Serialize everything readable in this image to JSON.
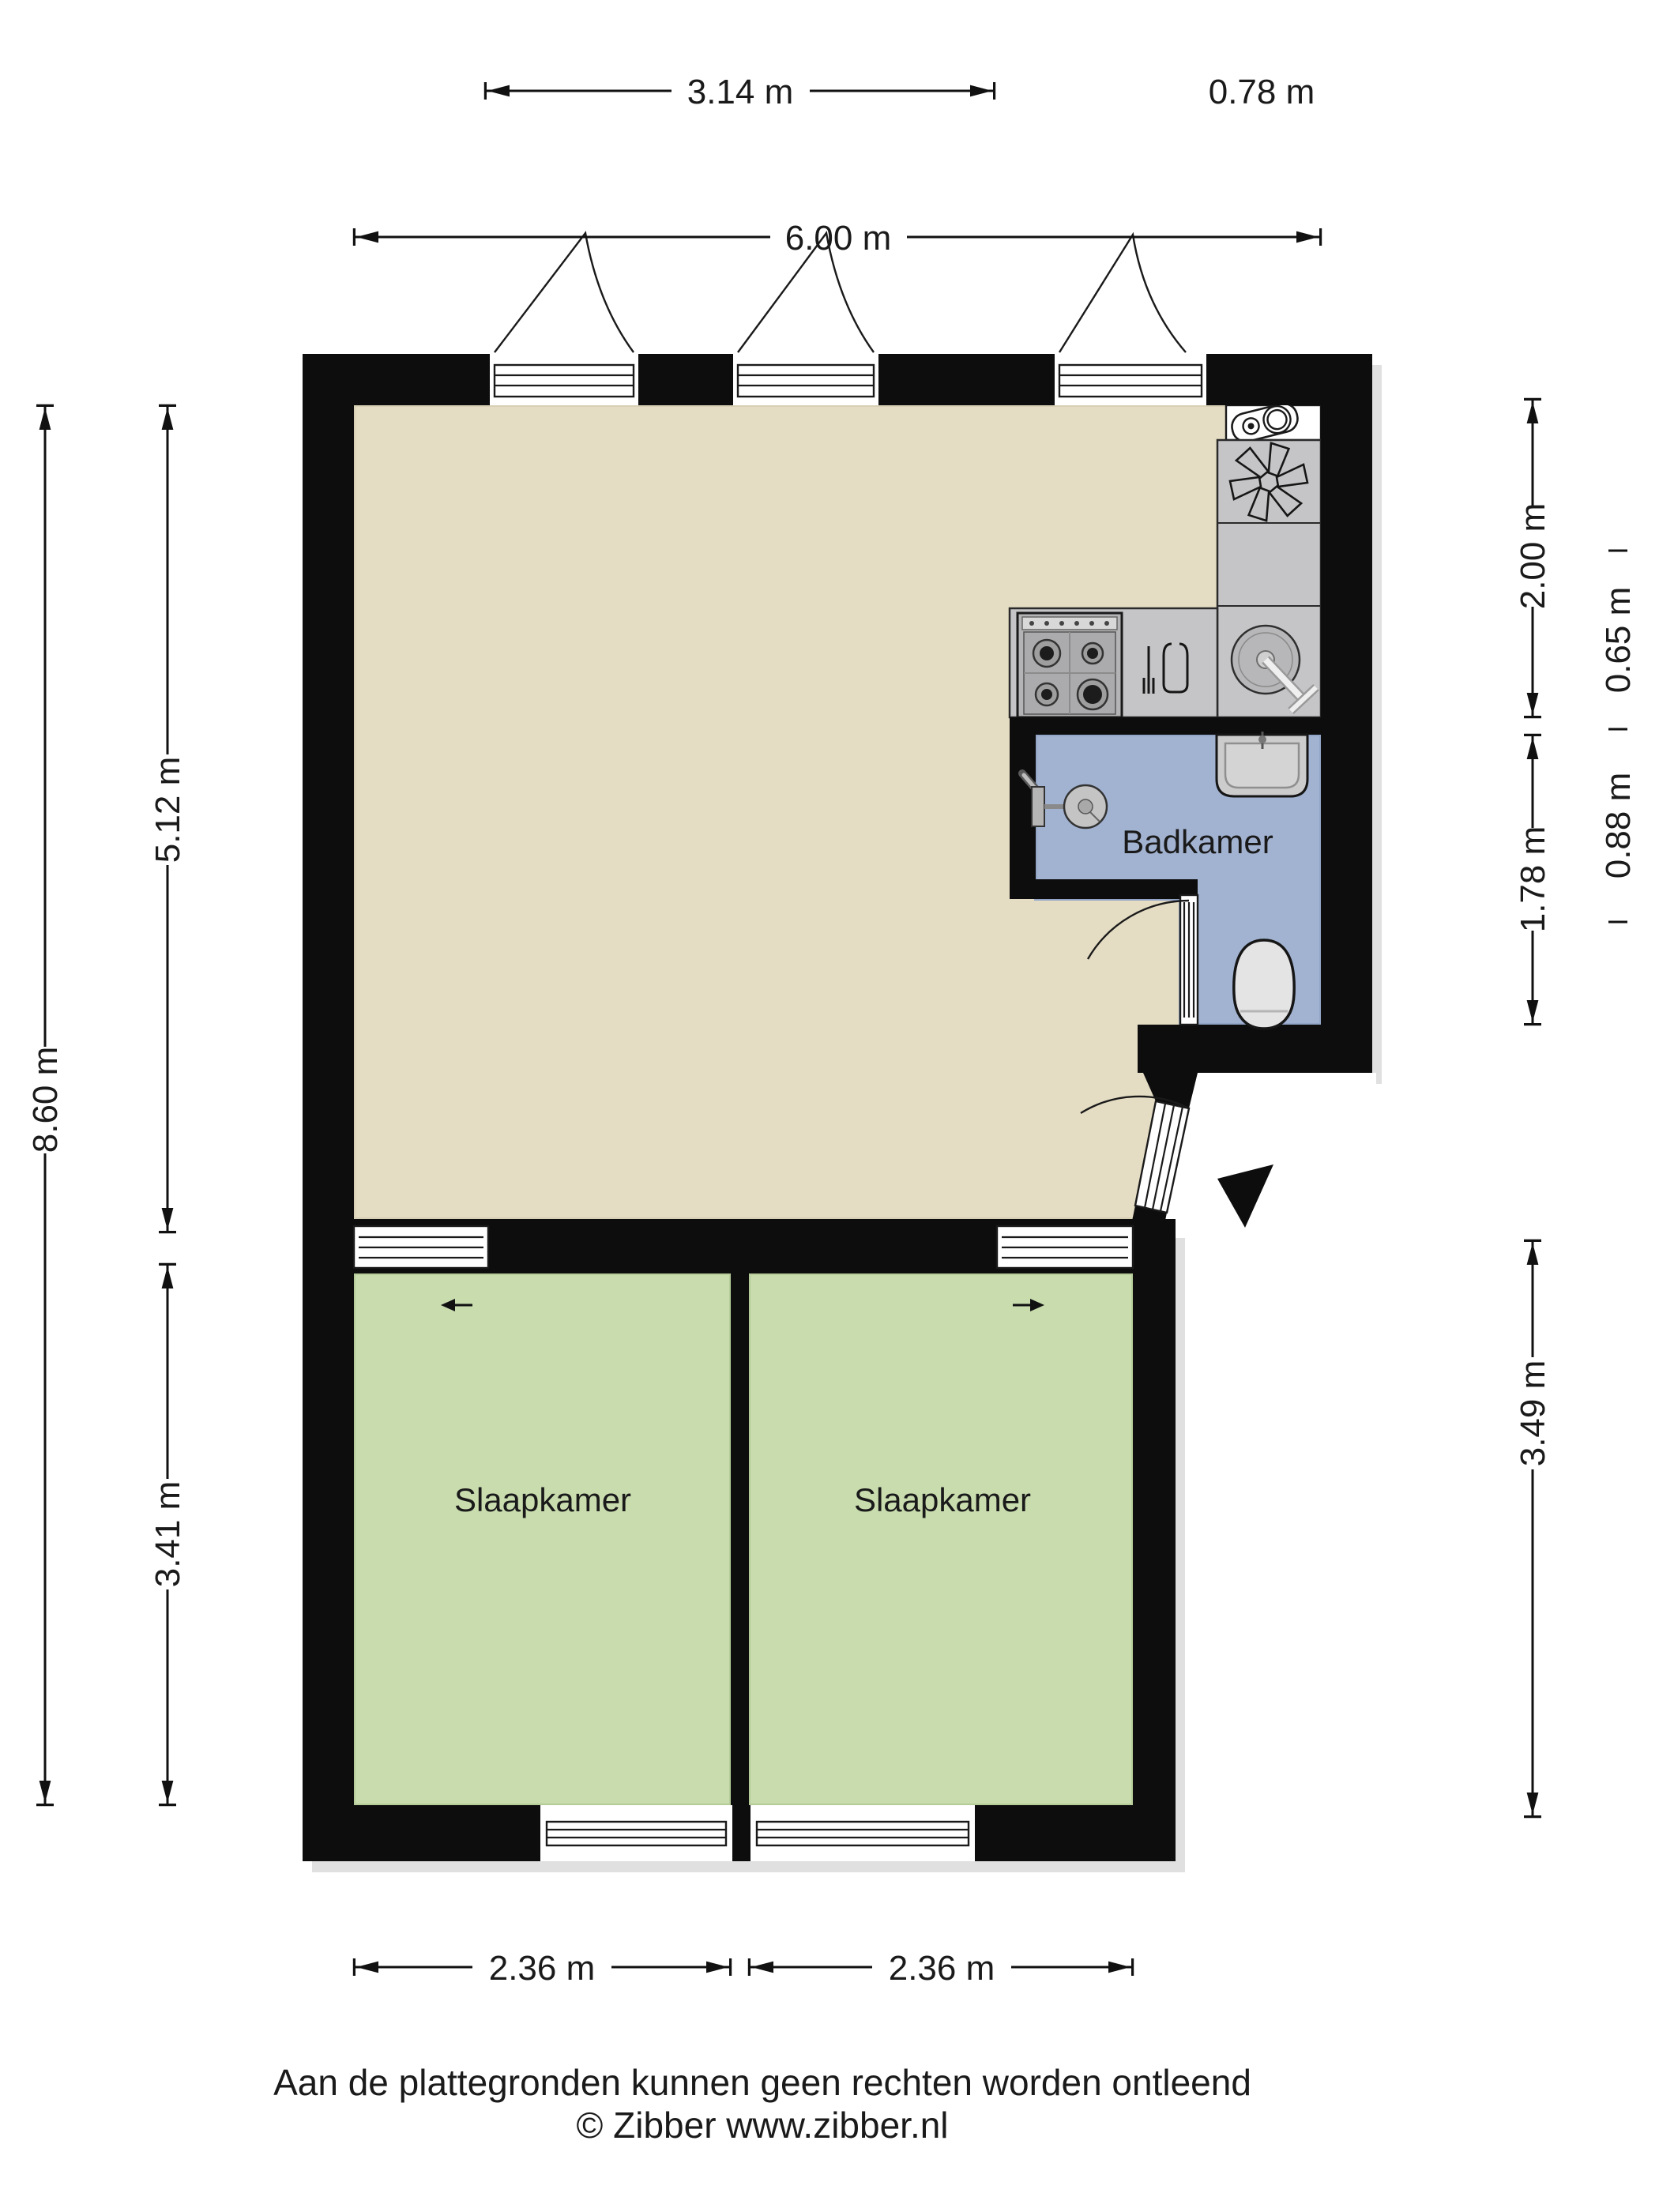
{
  "dimensions": {
    "top_inner": "3.14 m",
    "top_kitchen": "0.78 m",
    "top_total": "6.00 m",
    "left_total": "8.60 m",
    "left_living": "5.12 m",
    "left_bedroom": "3.41 m",
    "right_kitchen": "2.00 m",
    "right_kitchen_width": "0.65 m",
    "right_bathroom_width": "0.88 m",
    "right_bathroom": "1.78 m",
    "right_bedroom": "3.49 m",
    "bottom_bedroom_left": "2.36 m",
    "bottom_bedroom_right": "2.36 m"
  },
  "rooms": {
    "bathroom": "Badkamer",
    "bedroom_left": "Slaapkamer",
    "bedroom_right": "Slaapkamer"
  },
  "footer": {
    "disclaimer": "Aan de plattegronden kunnen geen rechten worden ontleend",
    "copyright": "© Zibber www.zibber.nl"
  },
  "icons": [
    "washing-machine-icon",
    "ventilation-fan-icon",
    "stove-icon",
    "dishwasher-icon",
    "kitchen-sink-icon",
    "shower-icon",
    "washbasin-icon",
    "toilet-icon",
    "entry-arrow-icon",
    "door-swing-icon",
    "window-icon",
    "sliding-door-icon"
  ],
  "colors": {
    "wall": "#0d0d0d",
    "living": "#e4dcc3",
    "bedroom": "#c8dcae",
    "bathroom": "#a2b3d1",
    "counter": "#c5c5c7",
    "dimension": "#111111",
    "text": "#1a1a1a"
  }
}
